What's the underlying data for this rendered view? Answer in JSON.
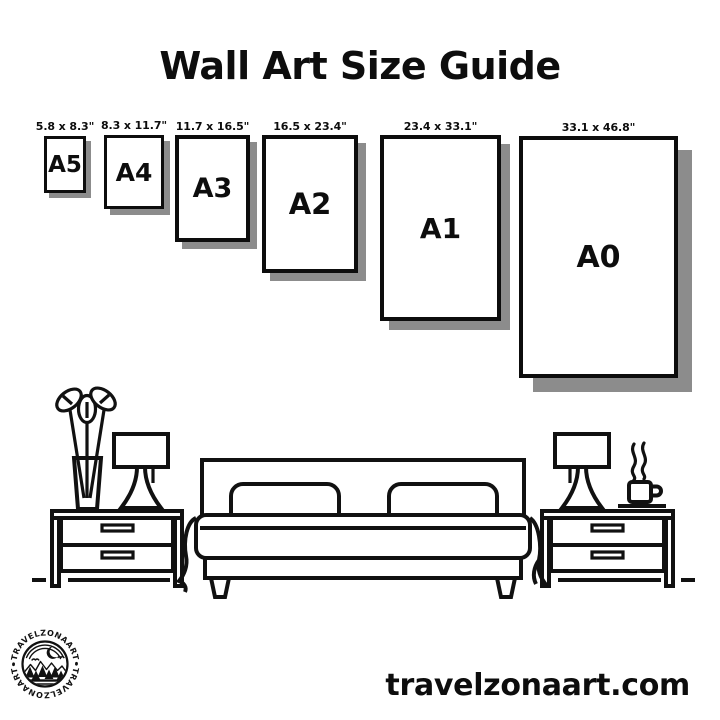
{
  "title": "Wall Art Size Guide",
  "frames": [
    {
      "name": "A5",
      "size": "5.8 x 8.3\""
    },
    {
      "name": "A4",
      "size": "8.3 x 11.7\""
    },
    {
      "name": "A3",
      "size": "11.7 x 16.5\""
    },
    {
      "name": "A2",
      "size": "16.5 x 23.4\""
    },
    {
      "name": "A1",
      "size": "23.4 x 33.1\""
    },
    {
      "name": "A0",
      "size": "33.1 x 46.8\""
    }
  ],
  "logo": {
    "brand_top": "•TRAVELZONAART•",
    "brand_bottom": "•TRAVELZONAART•"
  },
  "footer": {
    "website": "travelzonaart.com"
  },
  "illustration": {
    "icons": [
      "plant-vase-icon",
      "table-lamp-icon",
      "nightstand",
      "bed-icon",
      "coffee-cup-icon",
      "brand-logo-badge"
    ]
  },
  "colors": {
    "ink": "#111111",
    "frame_border": "#0d0d0d",
    "shadow": "#8c8c8c",
    "background": "#ffffff"
  }
}
